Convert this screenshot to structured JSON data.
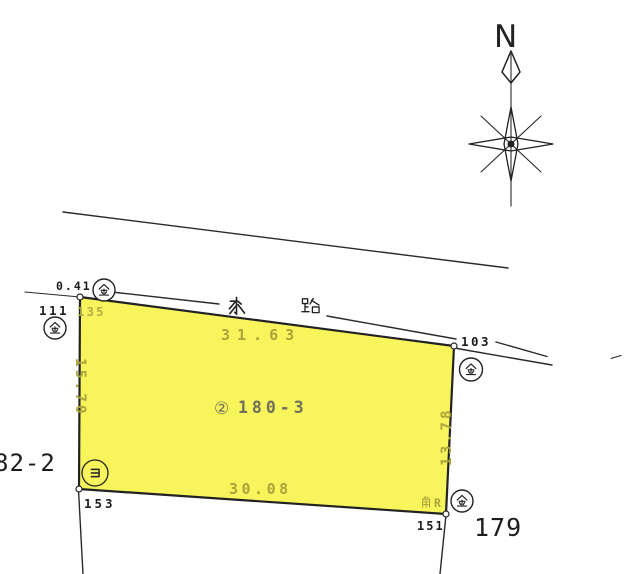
{
  "compass": {
    "north_label": "N"
  },
  "waterway": {
    "name": "水路",
    "char_mizu": "水",
    "char_ro": "路"
  },
  "parcel": {
    "number_symbol": "②",
    "number": "180-3",
    "dimensions": {
      "top": "31.63",
      "left": "15.70",
      "right": "13.78",
      "bottom": "30.08"
    },
    "corner_note": {
      "kanji": "角",
      "suffix": "R"
    }
  },
  "boundary_points": {
    "top_left": {
      "id": "135",
      "marker": "金"
    },
    "top_right": {
      "id": "103",
      "marker": "金"
    },
    "bottom_left": {
      "id": "153",
      "marker": "ヨ"
    },
    "bottom_right": {
      "id": "151",
      "marker": "金"
    },
    "offset": {
      "id": "111",
      "marker": "金",
      "distance": "0.41"
    }
  },
  "adjacent_parcels": {
    "east": "179",
    "west_partial": "82-2"
  },
  "colors": {
    "parcel_fill": "#f8f45c",
    "dimension_text": "#a9a43b",
    "parcel_number_text": "#70705c",
    "line": "#2a2a2a",
    "point_label_text": "#1c1c1c"
  }
}
